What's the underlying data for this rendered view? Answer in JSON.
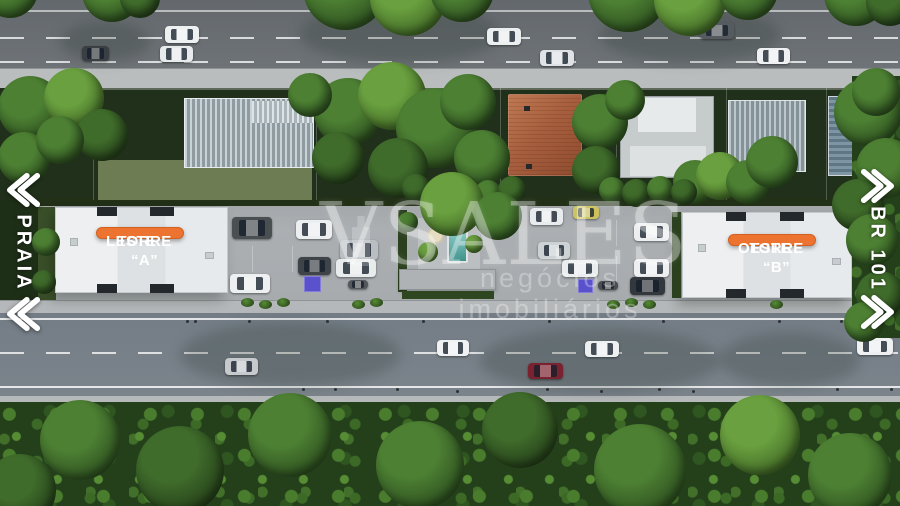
{
  "labels": {
    "left_road": "PRAIA",
    "right_road": "BR 101",
    "tower_a_line1": "TORRE “A”",
    "tower_a_line2": "LESTE",
    "tower_b_line1": "TORRE “B”",
    "tower_b_line2": "OESTE",
    "watermark_brand": "VSALES",
    "watermark_tagline": "negócios imobiliários"
  },
  "icons": {
    "left_chevrons": "double-chevron-left «",
    "right_chevrons": "double-chevron-right »"
  },
  "colors": {
    "badge_orange": "#ED7430",
    "badge_text": "#FFFFFF",
    "pool_teal": "#4FA39D",
    "accessible_parking_blue": "#5A52CC",
    "road_top_gray": "#6B7075",
    "road_bottom_gray": "#778088",
    "sidewalk_gray": "#B9BCBD",
    "site_paving": "#A8ACAF",
    "tower_roof_white": "#E9ECEE",
    "terracotta_roof": "#A85F3E",
    "forest_green": "#24401B",
    "watermark_white": "rgba(255,255,255,0.34)"
  },
  "scene": {
    "trees": [
      {
        "x": 10,
        "y": -10,
        "r": 28,
        "s": 1
      },
      {
        "x": 112,
        "y": -8,
        "r": 30,
        "s": 1
      },
      {
        "x": 140,
        "y": -2,
        "r": 20,
        "s": 0
      },
      {
        "x": 345,
        "y": -12,
        "r": 42,
        "s": 1
      },
      {
        "x": 408,
        "y": -2,
        "r": 38,
        "s": 2
      },
      {
        "x": 462,
        "y": -10,
        "r": 32,
        "s": 1
      },
      {
        "x": 628,
        "y": -8,
        "r": 40,
        "s": 1
      },
      {
        "x": 690,
        "y": 0,
        "r": 36,
        "s": 2
      },
      {
        "x": 748,
        "y": -10,
        "r": 30,
        "s": 1
      },
      {
        "x": 856,
        "y": -6,
        "r": 32,
        "s": 1
      },
      {
        "x": 890,
        "y": 2,
        "r": 24,
        "s": 0
      },
      {
        "x": 30,
        "y": 108,
        "r": 32,
        "s": 1
      },
      {
        "x": 74,
        "y": 98,
        "r": 30,
        "s": 2
      },
      {
        "x": 102,
        "y": 135,
        "r": 26,
        "s": 0
      },
      {
        "x": 24,
        "y": 158,
        "r": 26,
        "s": 1
      },
      {
        "x": 60,
        "y": 140,
        "r": 24,
        "s": 1
      },
      {
        "x": 348,
        "y": 112,
        "r": 34,
        "s": 1
      },
      {
        "x": 392,
        "y": 96,
        "r": 34,
        "s": 2
      },
      {
        "x": 436,
        "y": 128,
        "r": 40,
        "s": 1
      },
      {
        "x": 398,
        "y": 168,
        "r": 30,
        "s": 0
      },
      {
        "x": 468,
        "y": 102,
        "r": 28,
        "s": 1
      },
      {
        "x": 482,
        "y": 158,
        "r": 28,
        "s": 1
      },
      {
        "x": 338,
        "y": 158,
        "r": 26,
        "s": 0
      },
      {
        "x": 310,
        "y": 95,
        "r": 22,
        "s": 1
      },
      {
        "x": 600,
        "y": 122,
        "r": 28,
        "s": 1
      },
      {
        "x": 596,
        "y": 170,
        "r": 24,
        "s": 0
      },
      {
        "x": 625,
        "y": 100,
        "r": 20,
        "s": 1
      },
      {
        "x": 695,
        "y": 182,
        "r": 22,
        "s": 1
      },
      {
        "x": 720,
        "y": 176,
        "r": 24,
        "s": 2
      },
      {
        "x": 748,
        "y": 182,
        "r": 22,
        "s": 1
      },
      {
        "x": 772,
        "y": 162,
        "r": 26,
        "s": 1
      },
      {
        "x": 868,
        "y": 112,
        "r": 34,
        "s": 1
      },
      {
        "x": 886,
        "y": 168,
        "r": 30,
        "s": 1
      },
      {
        "x": 858,
        "y": 205,
        "r": 26,
        "s": 0
      },
      {
        "x": 416,
        "y": 188,
        "r": 14,
        "s": 0
      },
      {
        "x": 440,
        "y": 192,
        "r": 13,
        "s": 1
      },
      {
        "x": 464,
        "y": 189,
        "r": 14,
        "s": 0
      },
      {
        "x": 488,
        "y": 193,
        "r": 13,
        "s": 1
      },
      {
        "x": 512,
        "y": 190,
        "r": 14,
        "s": 0
      },
      {
        "x": 612,
        "y": 190,
        "r": 13,
        "s": 1
      },
      {
        "x": 636,
        "y": 193,
        "r": 14,
        "s": 0
      },
      {
        "x": 660,
        "y": 189,
        "r": 13,
        "s": 1
      },
      {
        "x": 684,
        "y": 192,
        "r": 13,
        "s": 0
      },
      {
        "x": 452,
        "y": 204,
        "r": 32,
        "s": 2
      },
      {
        "x": 498,
        "y": 216,
        "r": 24,
        "s": 1
      },
      {
        "x": 428,
        "y": 252,
        "r": 10,
        "s": 2
      },
      {
        "x": 408,
        "y": 222,
        "r": 10,
        "s": 1
      },
      {
        "x": 474,
        "y": 244,
        "r": 9,
        "s": 2
      },
      {
        "x": 872,
        "y": 240,
        "r": 26,
        "s": 1
      },
      {
        "x": 880,
        "y": 295,
        "r": 24,
        "s": 0
      },
      {
        "x": 864,
        "y": 322,
        "r": 20,
        "s": 1
      },
      {
        "x": 876,
        "y": 92,
        "r": 24,
        "s": 1
      },
      {
        "x": 46,
        "y": 242,
        "r": 14,
        "s": 1
      },
      {
        "x": 44,
        "y": 282,
        "r": 12,
        "s": 0
      },
      {
        "x": 80,
        "y": 440,
        "r": 40,
        "s": 1
      },
      {
        "x": 180,
        "y": 470,
        "r": 44,
        "s": 0
      },
      {
        "x": 290,
        "y": 435,
        "r": 42,
        "s": 1
      },
      {
        "x": 420,
        "y": 465,
        "r": 44,
        "s": 1
      },
      {
        "x": 520,
        "y": 430,
        "r": 38,
        "s": 0
      },
      {
        "x": 640,
        "y": 470,
        "r": 46,
        "s": 1
      },
      {
        "x": 760,
        "y": 435,
        "r": 40,
        "s": 2
      },
      {
        "x": 850,
        "y": 475,
        "r": 42,
        "s": 1
      },
      {
        "x": 20,
        "y": 490,
        "r": 36,
        "s": 0
      }
    ],
    "cars": [
      {
        "x": 82,
        "y": 46,
        "w": 27,
        "h": 15,
        "c": "#3a3f44"
      },
      {
        "x": 165,
        "y": 26,
        "w": 34,
        "h": 17,
        "c": "#eef1f2"
      },
      {
        "x": 160,
        "y": 46,
        "w": 33,
        "h": 16,
        "c": "#e8ebec"
      },
      {
        "x": 487,
        "y": 28,
        "w": 34,
        "h": 17,
        "c": "#eceff0"
      },
      {
        "x": 540,
        "y": 50,
        "w": 34,
        "h": 16,
        "c": "#dfe3e5"
      },
      {
        "x": 700,
        "y": 22,
        "w": 34,
        "h": 17,
        "c": "#565b60"
      },
      {
        "x": 757,
        "y": 48,
        "w": 33,
        "h": 16,
        "c": "#eef0f1"
      },
      {
        "x": 225,
        "y": 358,
        "w": 33,
        "h": 17,
        "c": "#c6cacd"
      },
      {
        "x": 437,
        "y": 340,
        "w": 32,
        "h": 16,
        "c": "#eff1f2"
      },
      {
        "x": 528,
        "y": 363,
        "w": 35,
        "h": 16,
        "c": "#7a2230"
      },
      {
        "x": 585,
        "y": 341,
        "w": 34,
        "h": 16,
        "c": "#edf0f1"
      },
      {
        "x": 857,
        "y": 338,
        "w": 36,
        "h": 17,
        "c": "#eef0f2"
      },
      {
        "x": 232,
        "y": 217,
        "w": 40,
        "h": 22,
        "c": "#4a4f52"
      },
      {
        "x": 296,
        "y": 220,
        "w": 36,
        "h": 19,
        "c": "#eceef0"
      },
      {
        "x": 340,
        "y": 240,
        "w": 38,
        "h": 20,
        "c": "#b9bec2"
      },
      {
        "x": 336,
        "y": 259,
        "w": 40,
        "h": 18,
        "c": "#e9eced"
      },
      {
        "x": 298,
        "y": 257,
        "w": 33,
        "h": 18,
        "c": "#3f444a"
      },
      {
        "x": 230,
        "y": 274,
        "w": 40,
        "h": 19,
        "c": "#edeff0"
      },
      {
        "x": 348,
        "y": 280,
        "w": 20,
        "h": 9,
        "c": "#54585c"
      },
      {
        "x": 573,
        "y": 206,
        "w": 26,
        "h": 13,
        "c": "#cbc25e"
      },
      {
        "x": 530,
        "y": 208,
        "w": 33,
        "h": 17,
        "c": "#e9ecee"
      },
      {
        "x": 538,
        "y": 242,
        "w": 32,
        "h": 17,
        "c": "#cdd2d5"
      },
      {
        "x": 634,
        "y": 223,
        "w": 35,
        "h": 18,
        "c": "#eceef0"
      },
      {
        "x": 562,
        "y": 260,
        "w": 36,
        "h": 17,
        "c": "#eaedee"
      },
      {
        "x": 634,
        "y": 259,
        "w": 35,
        "h": 18,
        "c": "#edeff1"
      },
      {
        "x": 630,
        "y": 277,
        "w": 35,
        "h": 18,
        "c": "#33383e"
      },
      {
        "x": 598,
        "y": 281,
        "w": 20,
        "h": 9,
        "c": "#4a4e52"
      }
    ],
    "shrubs": [
      {
        "x": 241,
        "y": 298
      },
      {
        "x": 259,
        "y": 300
      },
      {
        "x": 277,
        "y": 298
      },
      {
        "x": 352,
        "y": 300
      },
      {
        "x": 370,
        "y": 298
      },
      {
        "x": 607,
        "y": 300
      },
      {
        "x": 625,
        "y": 298
      },
      {
        "x": 643,
        "y": 300
      },
      {
        "x": 770,
        "y": 300
      }
    ],
    "parking_squares": [
      {
        "x": 304,
        "y": 276,
        "w": 17,
        "h": 16
      },
      {
        "x": 578,
        "y": 279,
        "w": 15,
        "h": 14
      }
    ],
    "dots": [
      {
        "x": 186,
        "y": 320
      },
      {
        "x": 194,
        "y": 320
      },
      {
        "x": 248,
        "y": 320
      },
      {
        "x": 326,
        "y": 320
      },
      {
        "x": 422,
        "y": 320
      },
      {
        "x": 548,
        "y": 320
      },
      {
        "x": 662,
        "y": 320
      },
      {
        "x": 778,
        "y": 320
      },
      {
        "x": 840,
        "y": 320
      },
      {
        "x": 302,
        "y": 388
      },
      {
        "x": 334,
        "y": 388
      },
      {
        "x": 396,
        "y": 388
      },
      {
        "x": 456,
        "y": 390
      },
      {
        "x": 546,
        "y": 388
      },
      {
        "x": 600,
        "y": 390
      },
      {
        "x": 658,
        "y": 388
      },
      {
        "x": 692,
        "y": 390
      },
      {
        "x": 836,
        "y": 388
      },
      {
        "x": 890,
        "y": 388
      }
    ],
    "road_shadows": [
      {
        "x": 300,
        "y": 4,
        "w": 200,
        "h": 60
      },
      {
        "x": 600,
        "y": 8,
        "w": 180,
        "h": 55
      },
      {
        "x": 60,
        "y": 22,
        "w": 90,
        "h": 40
      },
      {
        "x": 180,
        "y": 322,
        "w": 220,
        "h": 65
      },
      {
        "x": 480,
        "y": 328,
        "w": 240,
        "h": 65
      },
      {
        "x": 720,
        "y": 332,
        "w": 140,
        "h": 55
      }
    ]
  }
}
